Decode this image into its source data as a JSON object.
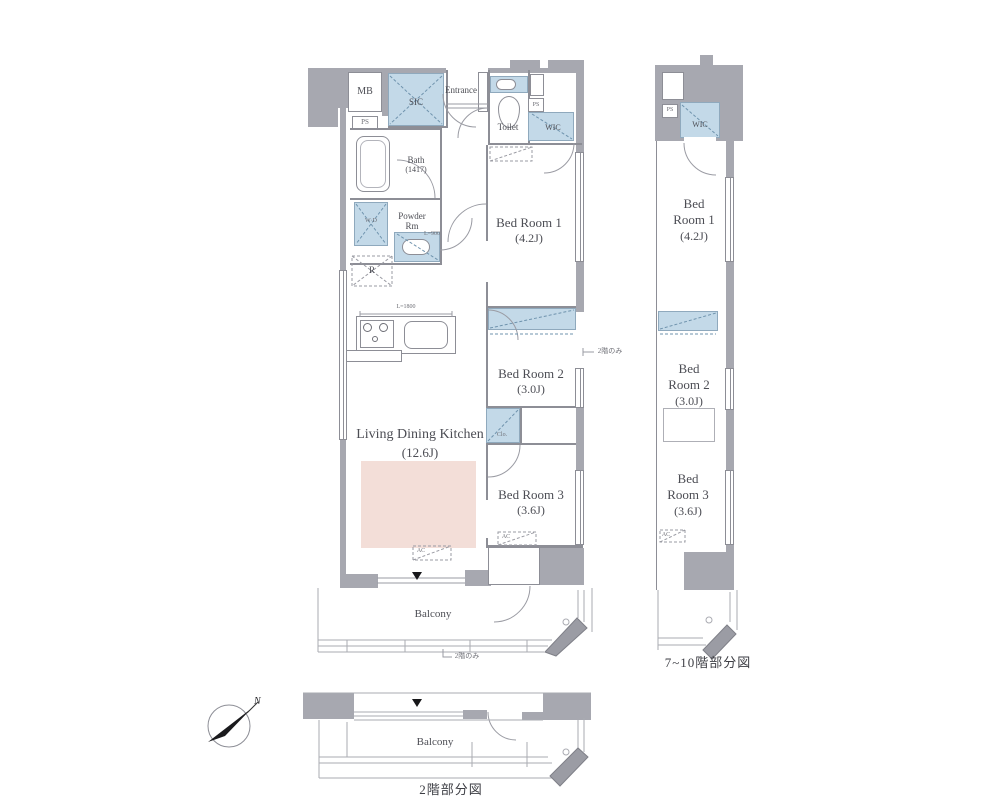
{
  "main_plan": {
    "mb": "MB",
    "ps_left": "PS",
    "sic": "SIC",
    "entrance": "Entrance",
    "toilet": "Toilet",
    "ps_right": "PS",
    "wic": "WIC",
    "bath_name": "Bath",
    "bath_size": "(1417)",
    "powder_line1": "Powder",
    "powder_line2": "Rm",
    "counter_note": "L=900",
    "washer": "W·D",
    "fridge": "R",
    "kitchen_note": "L=1800",
    "bed1_name": "Bed Room 1",
    "bed1_size": "(4.2J)",
    "bed2_name": "Bed Room 2",
    "bed2_size": "(3.0J)",
    "bed3_name": "Bed Room 3",
    "bed3_size": "(3.6J)",
    "ldk_name": "Living Dining Kitchen",
    "ldk_size": "(12.6J)",
    "closet": "Clo.",
    "ac": "AC",
    "balcony": "Balcony",
    "note_right": "2階のみ",
    "note_bottom": "2階のみ"
  },
  "upper_plan": {
    "caption": "7~10階部分図",
    "ps": "PS",
    "wic": "WIC",
    "bed1_l1": "Bed",
    "bed1_l2": "Room 1",
    "bed1_size": "(4.2J)",
    "bed2_l1": "Bed",
    "bed2_l2": "Room 2",
    "bed2_size": "(3.0J)",
    "bed3_l1": "Bed",
    "bed3_l2": "Room 3",
    "bed3_size": "(3.6J)",
    "ac": "AC"
  },
  "floor2_plan": {
    "caption": "2階部分図",
    "balcony": "Balcony"
  },
  "compass": {
    "north": "N"
  },
  "colors": {
    "wall": "#a7a8b0",
    "line": "#8d8e96",
    "closet_blue": "#c3d9e8",
    "rug_pink": "#f3ded8"
  }
}
